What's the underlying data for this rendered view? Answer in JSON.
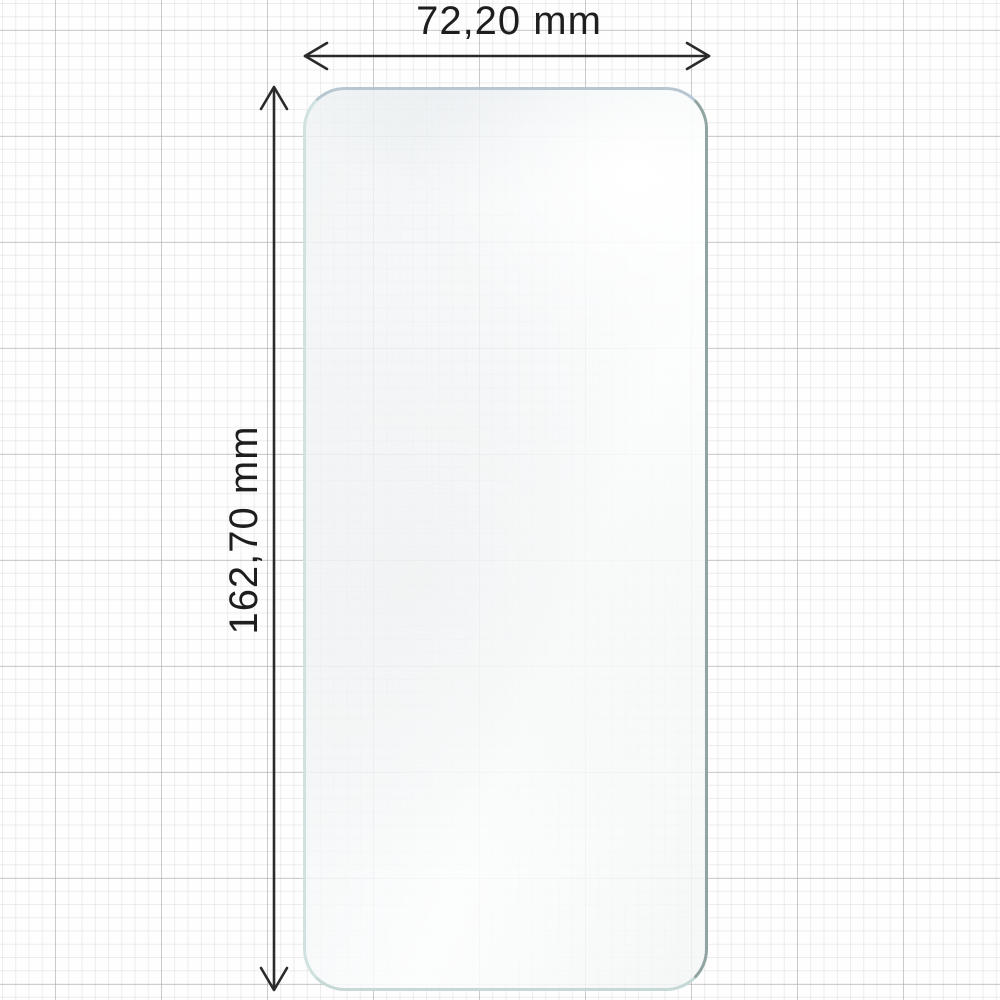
{
  "dimensions": {
    "width_label": "72,20 mm",
    "height_label": "162,70 mm"
  },
  "icons": {
    "width_arrow": "horizontal-double-arrow-icon",
    "height_arrow": "vertical-double-arrow-icon"
  },
  "colors": {
    "label_text": "#1e1e1e",
    "dimension_line": "#2a2a2a",
    "protector_edge_left": "#cfe2df",
    "protector_edge_right": "#90a5a2",
    "protector_edge_top": "#b7c7d1",
    "protector_edge_bottom": "#c6d9d6",
    "protector_fill": "#f4f6f7",
    "grid_minor": "#ebe9e9",
    "grid_major": "#d6d4d4",
    "paper": "#fefefe"
  }
}
